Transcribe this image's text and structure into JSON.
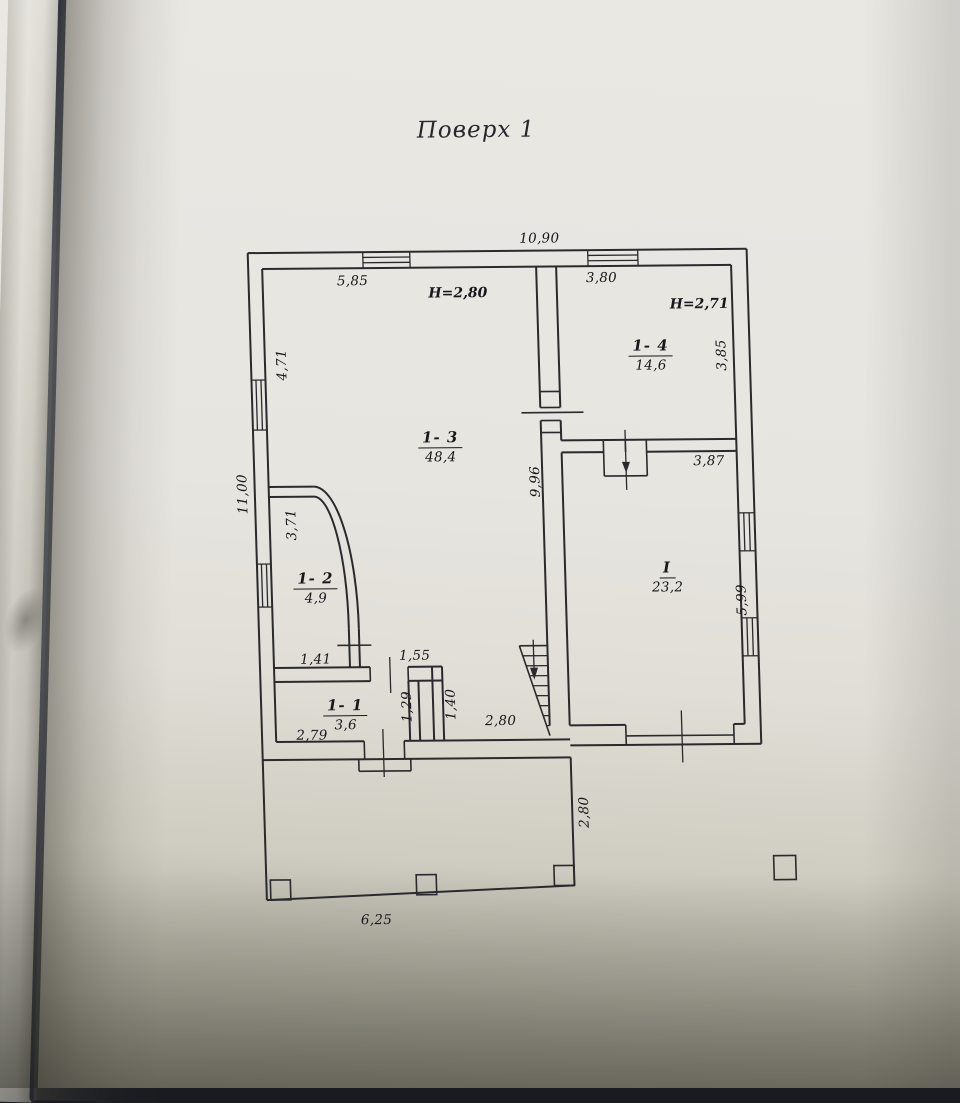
{
  "title": "Поверх 1",
  "photo": {
    "paper_color": "#e7e5e0",
    "line_color": "#2a2a2e",
    "text_color": "#17171c",
    "page_edge_dark": "#30343f",
    "bottom_shadow": "#8e8c7f"
  },
  "plan": {
    "rooms": [
      {
        "id": "1- 3",
        "area": "48,4",
        "x": 445,
        "y": 447
      },
      {
        "id": "1- 4",
        "area": "14,6",
        "x": 658,
        "y": 357
      },
      {
        "id": "1- 2",
        "area": "4,9",
        "x": 316,
        "y": 587
      },
      {
        "id": "1- 1",
        "area": "3,6",
        "x": 342,
        "y": 714
      },
      {
        "id": "I",
        "area": "23,2",
        "x": 668,
        "y": 579
      }
    ],
    "heights": [
      {
        "text": "H=2,80",
        "x": 467,
        "y": 293
      },
      {
        "text": "H=2,71",
        "x": 708,
        "y": 306
      }
    ],
    "dimensions": [
      {
        "text": "10,90",
        "x": 550,
        "y": 239,
        "rot": 0
      },
      {
        "text": "5,85",
        "x": 362,
        "y": 280,
        "rot": 0
      },
      {
        "text": "3,80",
        "x": 611,
        "y": 279,
        "rot": 0
      },
      {
        "text": "4,71",
        "x": 289,
        "y": 363,
        "rot": -90
      },
      {
        "text": "11,00",
        "x": 246,
        "y": 492,
        "rot": -90
      },
      {
        "text": "3,71",
        "x": 294,
        "y": 523,
        "rot": -90
      },
      {
        "text": "9,96",
        "x": 539,
        "y": 482,
        "rot": -90
      },
      {
        "text": "3,85",
        "x": 729,
        "y": 357,
        "rot": -90
      },
      {
        "text": "3,87",
        "x": 713,
        "y": 463,
        "rot": 0
      },
      {
        "text": "5,99",
        "x": 742,
        "y": 602,
        "rot": -90
      },
      {
        "text": "1,41",
        "x": 314,
        "y": 658,
        "rot": 0
      },
      {
        "text": "1,55",
        "x": 413,
        "y": 655,
        "rot": 0
      },
      {
        "text": "1,29",
        "x": 404,
        "y": 706,
        "rot": -90
      },
      {
        "text": "1,40",
        "x": 448,
        "y": 704,
        "rot": -90
      },
      {
        "text": "2,79",
        "x": 308,
        "y": 734,
        "rot": 0
      },
      {
        "text": "2,80",
        "x": 497,
        "y": 721,
        "rot": 0
      },
      {
        "text": "2,80",
        "x": 578,
        "y": 813,
        "rot": -90
      },
      {
        "text": "6,25",
        "x": 367,
        "y": 919,
        "rot": 0
      }
    ]
  }
}
